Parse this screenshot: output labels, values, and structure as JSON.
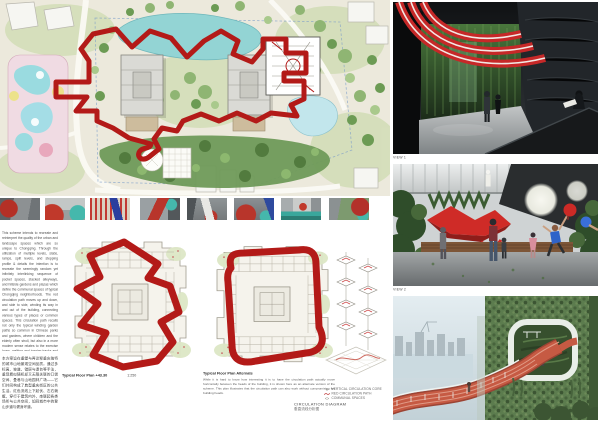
{
  "accent": {
    "red": "#b31a18",
    "lake": "#93d4d4",
    "track": "#c65a43"
  },
  "intro": {
    "text": "This scheme intends to recreate and reinterpret the quality of the urban and landscape spaces which are so unique to Chongqing. Through the utilization of multiple levels, slabs, ramps, split levels, and stepping profile & details the intention is to recreate the seemingly random yet infinitely interlinking sequence of pocket spaces, stacked alleyways, and hillside gardens and plazas which define the communal spaces of typical Chongqing neighborhoods. The red circulation path moves up and down, and side to side, winding its way in and out of the building, connecting various types of places or common spaces. This circulation path recalls not only the typical winding garden paths so common in Chinese parks and gardens, where children and the elderly often stroll, but also in a more modern sense relates to the exercise loops, walking and jogging tracks and pathways one finds oneself on when walking through the city."
  },
  "chinese": {
    "text": "本方案旨在重塑与再诠释重庆独特的城市山地景观空间品质。通过多标高、坡道、错层与退台等手法，重现看似随机却又无限关联的口袋空间、叠巷与山地园林广场——它们共同构成了典型重庆街区的公共生活。红色流线上下起伏、左右蜿蜒，穿行于建筑内外，串联起各类场所与公共空间，如同城市中的登山步道与健身环道。"
  },
  "plans": {
    "plan1": {
      "caption": "Typical Floor Plan +43.30",
      "scale": "1:250"
    },
    "plan2": {
      "caption": "Typical Floor Plan Alternate",
      "note": "While it is hard to know how interesting it is to have the circulation path actually move horizontally between the heads of the building, it is shown here as an alternate version of the scheme. This plan illustrates that the circulation path can also work without compromising the building heads."
    }
  },
  "diagram": {
    "title": "CIRCULATION DIAGRAM",
    "subtitle": "垂直流线分析图",
    "legend": [
      {
        "label": "VERTICAL CIRCULATION CORE"
      },
      {
        "label": "RED CIRCULATION PATH"
      },
      {
        "label": "COMMUNAL SPACES"
      }
    ]
  },
  "views": {
    "view1": "VIEW 1",
    "view2": "VIEW 2"
  }
}
